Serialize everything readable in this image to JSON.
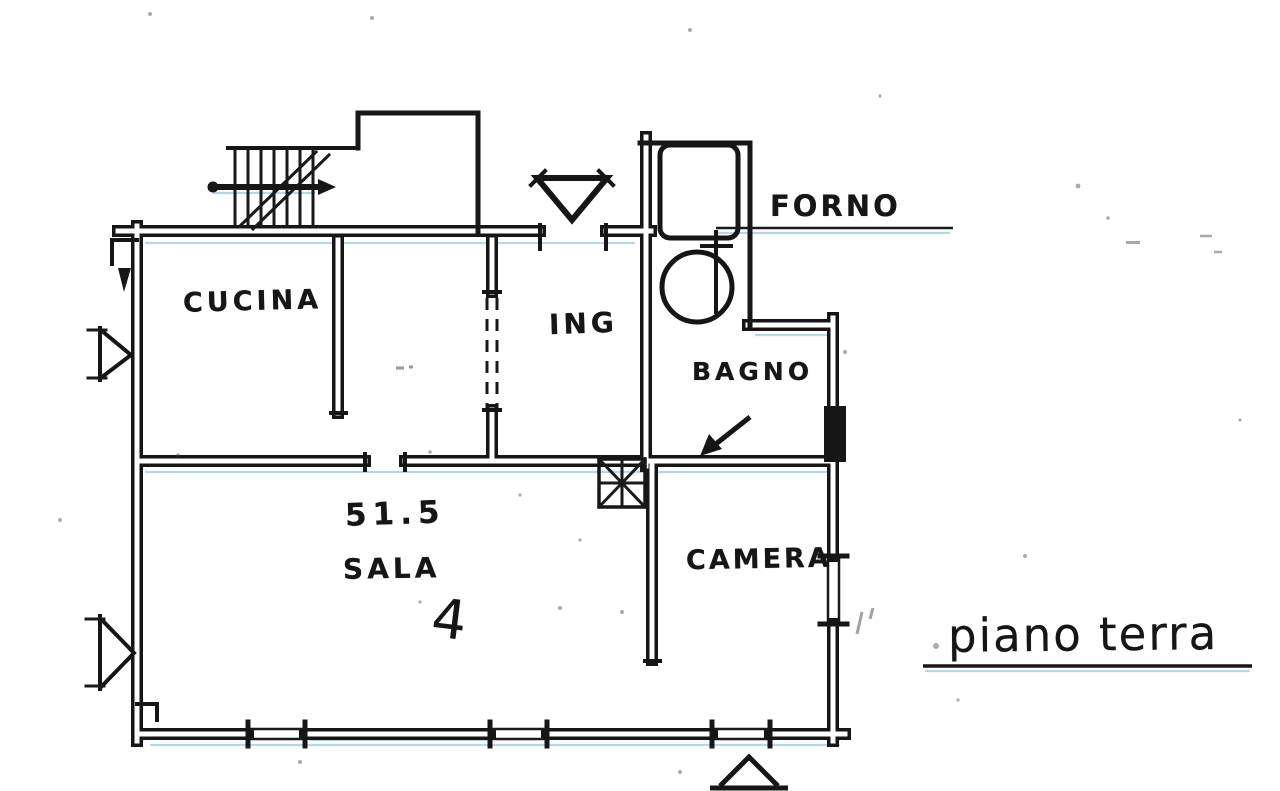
{
  "plan": {
    "caption": "piano terra",
    "rooms": {
      "cucina": "CUCINA",
      "ingresso": "ING",
      "bagno": "BAGNO",
      "sala": "SALA",
      "camera": "CAMERA"
    },
    "annotations": {
      "forno": "FORNO",
      "sala_area": "51.5",
      "sala_mark": "4"
    },
    "colors": {
      "ink": "#161616",
      "paper": "#ffffff",
      "scan_tint": "#6fb0cc"
    }
  }
}
